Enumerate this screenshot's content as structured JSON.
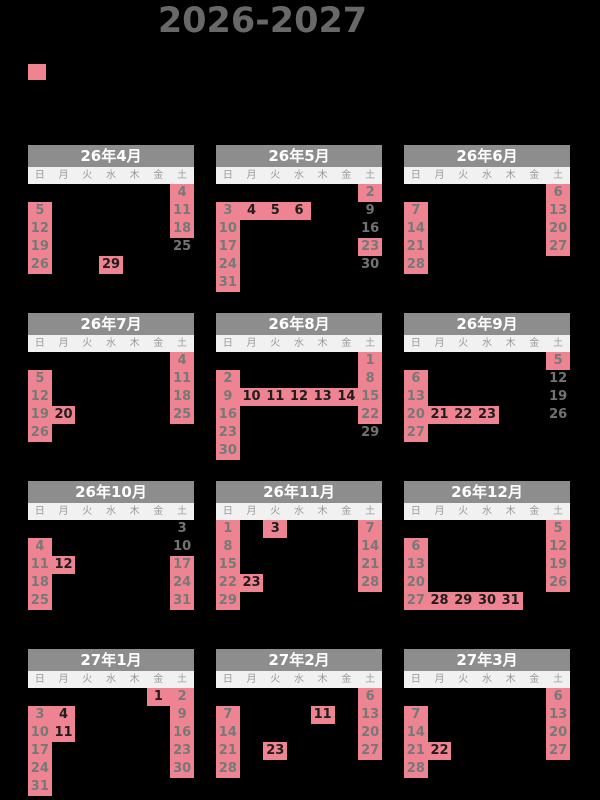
{
  "title": "2026-2027",
  "legend": {
    "holiday_swatch_color": "#ee8491"
  },
  "weekday_labels": [
    "日",
    "月",
    "火",
    "水",
    "木",
    "金",
    "土"
  ],
  "colors": {
    "background": "#000000",
    "title_text": "#686868",
    "month_header_bg": "#8d8d8d",
    "month_header_text": "#ffffff",
    "weekday_bar_bg": "#f1f1f1",
    "weekday_text": "#9a9a9a",
    "holiday_cell_bg": "#ee8491",
    "weekend_number_text": "#787878",
    "weekday_holiday_number_text": "#1e1e1e"
  },
  "months": [
    {
      "name": "26年4月",
      "first_dow": 3,
      "days": 30,
      "days_off": [
        4,
        5,
        11,
        12,
        18,
        19,
        26
      ],
      "public_holidays": [
        29
      ],
      "working_weekends": [
        25
      ]
    },
    {
      "name": "26年5月",
      "first_dow": 5,
      "days": 31,
      "days_off": [
        2,
        3,
        10,
        17,
        23,
        24,
        31
      ],
      "public_holidays": [
        4,
        5,
        6
      ],
      "working_weekends": [
        9,
        16,
        30
      ]
    },
    {
      "name": "26年6月",
      "first_dow": 1,
      "days": 30,
      "days_off": [
        6,
        7,
        13,
        14,
        20,
        21,
        27,
        28
      ],
      "public_holidays": [],
      "working_weekends": []
    },
    {
      "name": "26年7月",
      "first_dow": 3,
      "days": 31,
      "days_off": [
        4,
        5,
        11,
        12,
        18,
        19,
        25,
        26
      ],
      "public_holidays": [
        20
      ],
      "working_weekends": []
    },
    {
      "name": "26年8月",
      "first_dow": 6,
      "days": 31,
      "days_off": [
        1,
        2,
        8,
        9,
        15,
        16,
        22,
        23,
        30
      ],
      "public_holidays": [
        10,
        11,
        12,
        13,
        14
      ],
      "working_weekends": [
        29
      ]
    },
    {
      "name": "26年9月",
      "first_dow": 2,
      "days": 30,
      "days_off": [
        5,
        6,
        13,
        20,
        27
      ],
      "public_holidays": [
        21,
        22,
        23
      ],
      "working_weekends": [
        12,
        19,
        26
      ]
    },
    {
      "name": "26年10月",
      "first_dow": 4,
      "days": 31,
      "days_off": [
        4,
        11,
        17,
        18,
        24,
        25,
        31
      ],
      "public_holidays": [
        12
      ],
      "working_weekends": [
        3,
        10
      ]
    },
    {
      "name": "26年11月",
      "first_dow": 0,
      "days": 30,
      "days_off": [
        1,
        7,
        8,
        14,
        15,
        21,
        22,
        28,
        29
      ],
      "public_holidays": [
        3,
        23
      ],
      "working_weekends": []
    },
    {
      "name": "26年12月",
      "first_dow": 2,
      "days": 31,
      "days_off": [
        5,
        6,
        12,
        13,
        19,
        20,
        26,
        27
      ],
      "public_holidays": [
        28,
        29,
        30,
        31
      ],
      "working_weekends": []
    },
    {
      "name": "27年1月",
      "first_dow": 5,
      "days": 31,
      "days_off": [
        2,
        3,
        9,
        10,
        16,
        17,
        23,
        24,
        30,
        31
      ],
      "public_holidays": [
        1,
        4,
        11
      ],
      "working_weekends": []
    },
    {
      "name": "27年2月",
      "first_dow": 1,
      "days": 28,
      "days_off": [
        6,
        7,
        13,
        14,
        20,
        21,
        27,
        28
      ],
      "public_holidays": [
        11,
        23
      ],
      "working_weekends": []
    },
    {
      "name": "27年3月",
      "first_dow": 1,
      "days": 31,
      "days_off": [
        6,
        7,
        13,
        14,
        20,
        21,
        27,
        28
      ],
      "public_holidays": [
        22
      ],
      "working_weekends": []
    }
  ]
}
